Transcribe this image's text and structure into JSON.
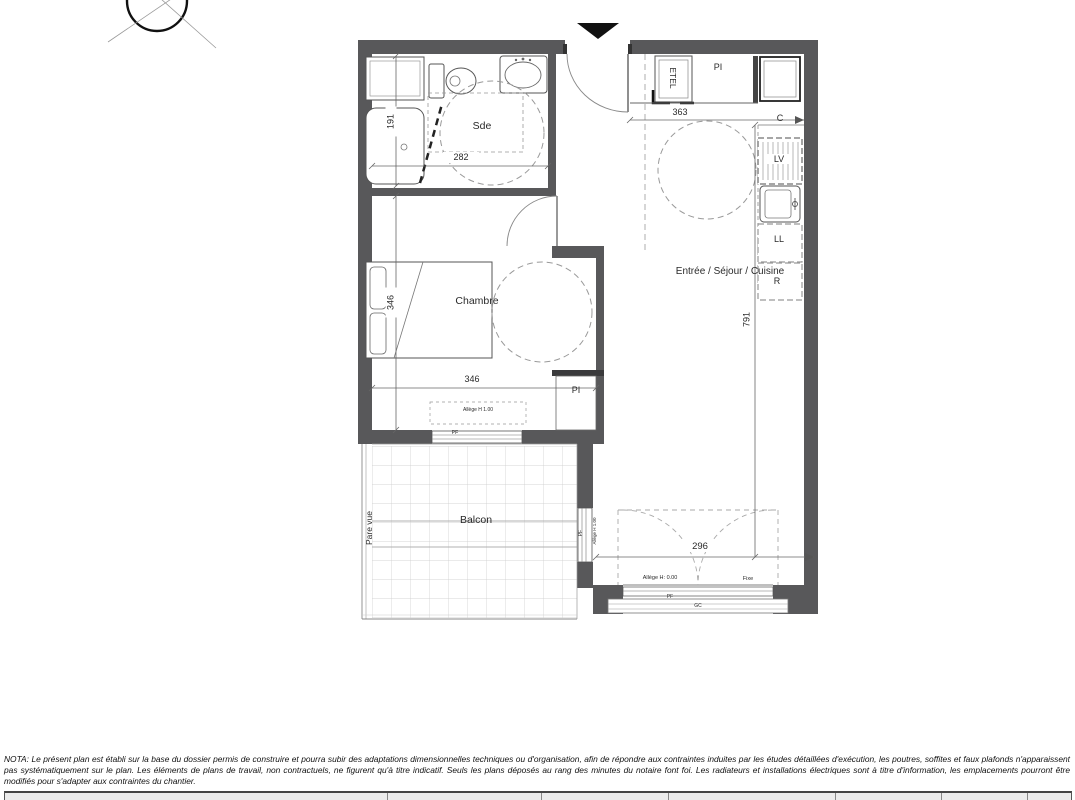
{
  "plan": {
    "rooms": {
      "sde": "Sde",
      "chambre": "Chambre",
      "sejour": "Entrée / Séjour / Cuisine",
      "balcon": "Balcon"
    },
    "annotations": {
      "etel": "ETEL",
      "pi_entry": "PI",
      "pi_chambre": "PI",
      "cooker": "C",
      "dishwasher": "LV",
      "washer": "LL",
      "fridge": "R",
      "pare_vue": "Pare vue",
      "pf_chambre_window": "PF",
      "allege_chambre_window": "Allège H 1.00",
      "pf_balcony_window": "PF",
      "allege_balcony_window": "Allège H 1.00",
      "allege_bay_window": "Allège H: 0.00",
      "fixe": "Fixe",
      "pf_bay_window": "PF",
      "gc_bay_window": "GC"
    },
    "dimensions": {
      "sde_width": "282",
      "sde_depth": "191",
      "entry_width": "363",
      "chambre_width": "346",
      "chambre_depth": "346",
      "sejour_depth": "791",
      "bay_width": "296"
    },
    "colors": {
      "wall": "#58585a",
      "line": "#555555",
      "dashed": "#999999",
      "north_marker": "#111111"
    }
  },
  "nota": "NOTA: Le présent plan est établi sur la base du dossier permis de construire et pourra subir des adaptations dimensionnelles techniques ou d'organisation, afin de répondre aux contraintes induites par les études détaillées d'exécution, les poutres, soffites et faux plafonds n'apparaissent pas systématiquement sur le plan. Les éléments de plans de travail, non contractuels, ne figurent qu'à titre indicatif. Seuls les plans déposés au rang des minutes du notaire font foi. Les radiateurs et installations électriques sont à titre d'information, les emplacements pourront être modifiés pour s'adapter aux contraintes du chantier."
}
